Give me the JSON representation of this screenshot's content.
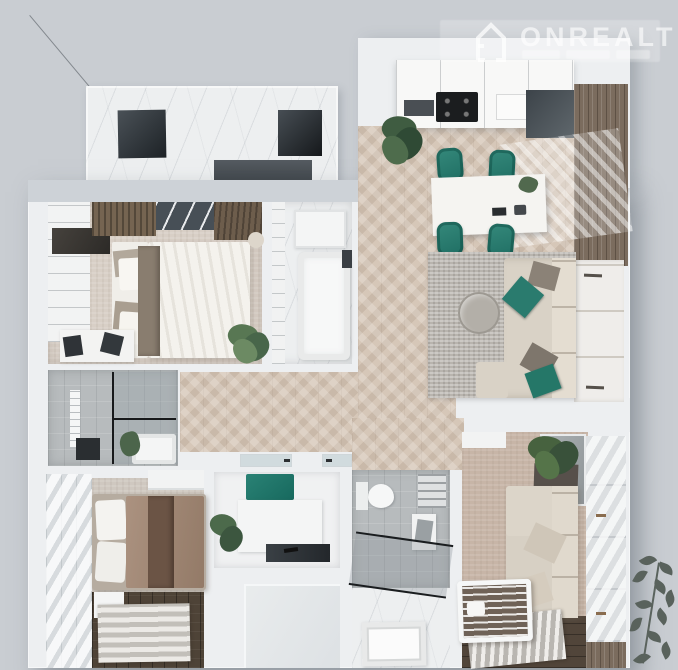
{
  "watermark": {
    "brand": "ONREALT",
    "icon": "house-icon"
  },
  "scene": {
    "type": "3d-rendered apartment floor plan, top-down view",
    "rooms": [
      "terrace",
      "master-bedroom",
      "bathtub-room",
      "kitchen-living-room",
      "hallway",
      "shower-bathroom",
      "laundry-closet",
      "main-bathroom",
      "second-bedroom",
      "nursery"
    ]
  },
  "colors": {
    "background": "#c9cdd2",
    "walls": "#edeff1",
    "accent_teal": "#2a7f72",
    "herringbone_floor": "#d6c7b8",
    "carpet_beige": "#d8cfc6",
    "living_rug_gray": "#b8b4ae",
    "balcony_wood": "#7b6c5e",
    "dark_wood_floor": "#4e4337",
    "nursery_walls": "#c7b5a7",
    "shower_glass": "#5b6468",
    "watermark_text": "rgba(255,255,255,0.62)"
  }
}
